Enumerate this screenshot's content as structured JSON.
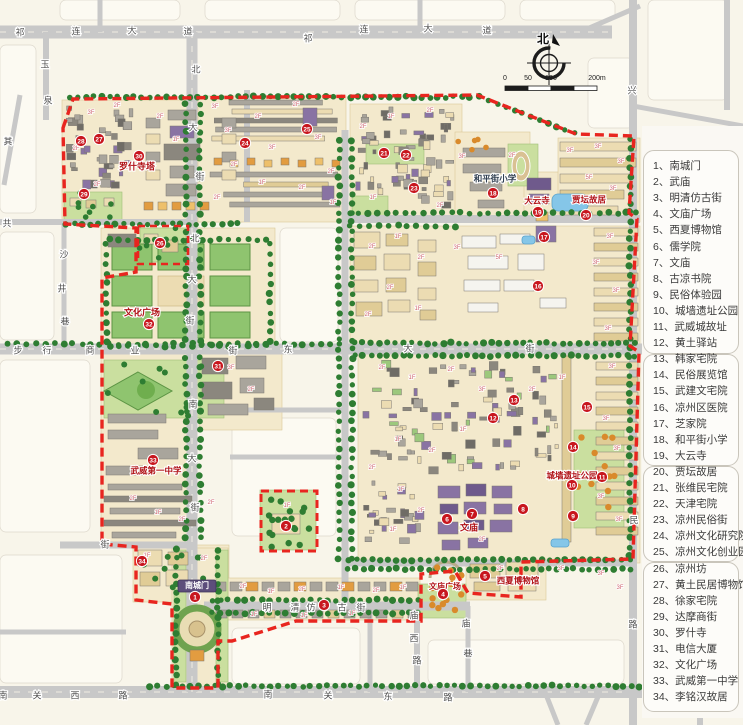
{
  "legend": {
    "items": [
      {
        "num": "1",
        "label": "南城门"
      },
      {
        "num": "2",
        "label": "武庙"
      },
      {
        "num": "3",
        "label": "明清仿古街"
      },
      {
        "num": "4",
        "label": "文庙广场"
      },
      {
        "num": "5",
        "label": "西夏博物馆"
      },
      {
        "num": "6",
        "label": "儒学院"
      },
      {
        "num": "7",
        "label": "文庙"
      },
      {
        "num": "8",
        "label": "古凉书院"
      },
      {
        "num": "9",
        "label": "民俗体验园"
      },
      {
        "num": "10",
        "label": "城墙遗址公园"
      },
      {
        "num": "11",
        "label": "武威城故址"
      },
      {
        "num": "12",
        "label": "黄土驿站"
      },
      {
        "num": "13",
        "label": "韩家宅院"
      },
      {
        "num": "14",
        "label": "民俗展览馆"
      },
      {
        "num": "15",
        "label": "武建文宅院"
      },
      {
        "num": "16",
        "label": "凉州区医院"
      },
      {
        "num": "17",
        "label": "芝家院"
      },
      {
        "num": "18",
        "label": "和平街小学"
      },
      {
        "num": "19",
        "label": "大云寺"
      },
      {
        "num": "20",
        "label": "贾坛故居"
      },
      {
        "num": "21",
        "label": "张维民宅院"
      },
      {
        "num": "22",
        "label": "天津宅院"
      },
      {
        "num": "23",
        "label": "凉州民俗街"
      },
      {
        "num": "24",
        "label": "凉州文化研究院"
      },
      {
        "num": "25",
        "label": "凉州文化创业园"
      },
      {
        "num": "26",
        "label": "凉州坊"
      },
      {
        "num": "27",
        "label": "黄土民居博物馆"
      },
      {
        "num": "28",
        "label": "徐家宅院"
      },
      {
        "num": "29",
        "label": "达摩商街"
      },
      {
        "num": "30",
        "label": "罗什寺"
      },
      {
        "num": "31",
        "label": "电信大厦"
      },
      {
        "num": "32",
        "label": "文化广场"
      },
      {
        "num": "33",
        "label": "武威第一中学"
      },
      {
        "num": "34",
        "label": "李铭汉故居"
      }
    ]
  },
  "compass": {
    "north": "北"
  },
  "scale_bar": {
    "ticks": [
      "0",
      "50",
      "100",
      "200m"
    ]
  },
  "markers": [
    [
      1,
      195,
      597
    ],
    [
      2,
      286,
      526
    ],
    [
      3,
      324,
      605
    ],
    [
      4,
      443,
      594
    ],
    [
      5,
      485,
      576
    ],
    [
      6,
      447,
      519
    ],
    [
      7,
      472,
      514
    ],
    [
      8,
      523,
      509
    ],
    [
      9,
      573,
      516
    ],
    [
      10,
      572,
      485
    ],
    [
      11,
      602,
      477
    ],
    [
      12,
      493,
      418
    ],
    [
      13,
      514,
      400
    ],
    [
      14,
      573,
      447
    ],
    [
      15,
      587,
      407
    ],
    [
      16,
      538,
      286
    ],
    [
      17,
      544,
      237
    ],
    [
      18,
      493,
      193
    ],
    [
      19,
      538,
      212
    ],
    [
      20,
      586,
      215
    ],
    [
      21,
      384,
      153
    ],
    [
      22,
      406,
      155
    ],
    [
      23,
      414,
      188
    ],
    [
      24,
      245,
      143
    ],
    [
      25,
      307,
      129
    ],
    [
      26,
      160,
      243
    ],
    [
      27,
      99,
      139
    ],
    [
      28,
      81,
      141
    ],
    [
      29,
      84,
      194
    ],
    [
      30,
      139,
      156
    ],
    [
      31,
      218,
      366
    ],
    [
      32,
      149,
      324
    ],
    [
      33,
      153,
      460
    ],
    [
      34,
      142,
      561
    ]
  ],
  "streets": [
    {
      "name": "qilian-avenue-west",
      "chars": [
        [
          "祁",
          20,
          33
        ],
        [
          "连",
          76,
          32
        ],
        [
          "大",
          132,
          31
        ],
        [
          "道",
          188,
          32
        ]
      ]
    },
    {
      "name": "qilian-avenue-east",
      "chars": [
        [
          "祁",
          308,
          39
        ],
        [
          "连",
          364,
          30
        ],
        [
          "大",
          428,
          29
        ],
        [
          "道",
          487,
          31
        ]
      ]
    },
    {
      "name": "bei-da-jie-upper",
      "chars": [
        [
          "北",
          196,
          70
        ],
        [
          "大",
          193,
          128
        ],
        [
          "街",
          200,
          177
        ]
      ]
    },
    {
      "name": "bei-da-jie-lower",
      "chars": [
        [
          "北",
          195,
          239
        ],
        [
          "大",
          192,
          280
        ],
        [
          "街",
          190,
          321
        ]
      ]
    },
    {
      "name": "nan-da-jie",
      "chars": [
        [
          "南",
          193,
          405
        ],
        [
          "大",
          192,
          459
        ],
        [
          "街",
          195,
          508
        ]
      ]
    },
    {
      "name": "dong-da-jie",
      "chars": [
        [
          "东",
          288,
          350
        ],
        [
          "大",
          408,
          349
        ],
        [
          "街",
          530,
          349
        ]
      ]
    },
    {
      "name": "buxing-shangye-jie",
      "chars": [
        [
          "步",
          18,
          351
        ],
        [
          "行",
          47,
          351
        ],
        [
          "商",
          90,
          351
        ],
        [
          "业",
          135,
          351
        ],
        [
          "街",
          233,
          351
        ]
      ]
    },
    {
      "name": "shajing-lane",
      "chars": [
        [
          "沙",
          64,
          255
        ],
        [
          "井",
          62,
          289
        ],
        [
          "巷",
          65,
          322
        ]
      ]
    },
    {
      "name": "yuquan-road",
      "chars": [
        [
          "玉",
          45,
          65
        ],
        [
          "泉",
          48,
          101
        ]
      ]
    },
    {
      "name": "west-edge-street",
      "chars": [
        [
          "其",
          8,
          142
        ]
      ]
    },
    {
      "name": "gong-street",
      "chars": [
        [
          "共",
          7,
          224
        ]
      ]
    },
    {
      "name": "west-jie",
      "chars": [
        [
          "街",
          105,
          545
        ]
      ]
    },
    {
      "name": "mingqing-fanggu-jie",
      "chars": [
        [
          "明",
          267,
          608
        ],
        [
          "清",
          295,
          608
        ],
        [
          "仿",
          311,
          608
        ],
        [
          "古",
          342,
          608
        ],
        [
          "街",
          361,
          608
        ]
      ]
    },
    {
      "name": "miaoxi-road",
      "chars": [
        [
          "庙",
          414,
          616
        ],
        [
          "西",
          414,
          639
        ],
        [
          "路",
          417,
          661
        ]
      ]
    },
    {
      "name": "miao-lane",
      "chars": [
        [
          "庙",
          466,
          624
        ],
        [
          "巷",
          468,
          654
        ]
      ]
    },
    {
      "name": "nanguan-west-road",
      "chars": [
        [
          "南",
          3,
          696
        ],
        [
          "关",
          37,
          696
        ],
        [
          "西",
          75,
          696
        ],
        [
          "路",
          123,
          696
        ]
      ]
    },
    {
      "name": "nanguan-east-road",
      "chars": [
        [
          "南",
          268,
          695
        ],
        [
          "关",
          328,
          696
        ],
        [
          "东",
          388,
          697
        ],
        [
          "路",
          448,
          698
        ]
      ]
    },
    {
      "name": "east-edge-roads",
      "chars": [
        [
          "兴",
          632,
          91
        ],
        [
          "民",
          634,
          521
        ],
        [
          "路",
          633,
          625
        ]
      ]
    }
  ],
  "map_labels": [
    {
      "text": "罗什寺塔",
      "x": 137,
      "y": 167,
      "color": "#b01116",
      "size": 9
    },
    {
      "text": "文化广场",
      "x": 142,
      "y": 313,
      "color": "#b01116",
      "size": 9
    },
    {
      "text": "武威第一中学",
      "x": 156,
      "y": 471,
      "color": "#b01116",
      "size": 8.5
    },
    {
      "text": "文庙广场",
      "x": 445,
      "y": 587,
      "color": "#b01116",
      "size": 8
    },
    {
      "text": "西夏博物馆",
      "x": 518,
      "y": 581,
      "color": "#b01116",
      "size": 8.5
    },
    {
      "text": "文庙",
      "x": 469,
      "y": 528,
      "color": "#b01116",
      "size": 9
    },
    {
      "text": "城墙遗址公园",
      "x": 572,
      "y": 476,
      "color": "#b01116",
      "size": 8.5
    },
    {
      "text": "大云寺",
      "x": 537,
      "y": 201,
      "color": "#b01116",
      "size": 8.5
    },
    {
      "text": "贾坛故居",
      "x": 589,
      "y": 200,
      "color": "#b01116",
      "size": 8.5
    },
    {
      "text": "和平街小学",
      "x": 495,
      "y": 179,
      "color": "#2f3e50",
      "size": 8.5
    },
    {
      "text": "南城门",
      "x": 197,
      "y": 586,
      "color": "#ffffff",
      "size": 8,
      "chip": "#5d4e7b"
    }
  ],
  "floor_labels": [
    [
      "3F",
      91,
      114
    ],
    [
      "2F",
      117,
      107
    ],
    [
      "2F",
      76,
      150
    ],
    [
      "1F",
      128,
      169
    ],
    [
      "2F",
      97,
      186
    ],
    [
      "2F",
      160,
      118
    ],
    [
      "1F",
      176,
      141
    ],
    [
      "3F",
      215,
      108
    ],
    [
      "3F",
      228,
      132
    ],
    [
      "2F",
      258,
      118
    ],
    [
      "3F",
      272,
      149
    ],
    [
      "2F",
      296,
      106
    ],
    [
      "3F",
      318,
      139
    ],
    [
      "2F",
      234,
      166
    ],
    [
      "1F",
      262,
      184
    ],
    [
      "2F",
      302,
      189
    ],
    [
      "2F",
      331,
      173
    ],
    [
      "2F",
      217,
      199
    ],
    [
      "1F",
      333,
      204
    ],
    [
      "2F",
      363,
      128
    ],
    [
      "1F",
      391,
      118
    ],
    [
      "2F",
      430,
      112
    ],
    [
      "1F",
      373,
      199
    ],
    [
      "2F",
      440,
      207
    ],
    [
      "3F",
      462,
      158
    ],
    [
      "2F",
      512,
      157
    ],
    [
      "3F",
      570,
      152
    ],
    [
      "3F",
      598,
      148
    ],
    [
      "3F",
      621,
      163
    ],
    [
      "5F",
      589,
      179
    ],
    [
      "3F",
      613,
      190
    ],
    [
      "2F",
      372,
      248
    ],
    [
      "1F",
      398,
      238
    ],
    [
      "2F",
      421,
      259
    ],
    [
      "3F",
      457,
      249
    ],
    [
      "5F",
      499,
      259
    ],
    [
      "3F",
      610,
      238
    ],
    [
      "3F",
      596,
      264
    ],
    [
      "3F",
      616,
      292
    ],
    [
      "2F",
      390,
      289
    ],
    [
      "1F",
      418,
      310
    ],
    [
      "2F",
      368,
      316
    ],
    [
      "3F",
      608,
      330
    ],
    [
      "2F",
      382,
      369
    ],
    [
      "1F",
      412,
      379
    ],
    [
      "2F",
      451,
      371
    ],
    [
      "3F",
      482,
      391
    ],
    [
      "2F",
      532,
      391
    ],
    [
      "1F",
      562,
      379
    ],
    [
      "3F",
      612,
      368
    ],
    [
      "3F",
      606,
      420
    ],
    [
      "3F",
      617,
      450
    ],
    [
      "3F",
      601,
      498
    ],
    [
      "3F",
      619,
      521
    ],
    [
      "1F",
      398,
      441
    ],
    [
      "2F",
      432,
      452
    ],
    [
      "1F",
      463,
      431
    ],
    [
      "2F",
      372,
      469
    ],
    [
      "1F",
      401,
      491
    ],
    [
      "2F",
      421,
      512
    ],
    [
      "1F",
      393,
      531
    ],
    [
      "2F",
      482,
      541
    ],
    [
      "3F",
      231,
      369
    ],
    [
      "2F",
      251,
      391
    ],
    [
      "2F",
      133,
      500
    ],
    [
      "1F",
      158,
      514
    ],
    [
      "2F",
      182,
      521
    ],
    [
      "2F",
      211,
      504
    ],
    [
      "2F",
      243,
      588
    ],
    [
      "1F",
      271,
      593
    ],
    [
      "2F",
      302,
      591
    ],
    [
      "1F",
      341,
      589
    ],
    [
      "2F",
      376,
      592
    ],
    [
      "1F",
      403,
      589
    ],
    [
      "1F",
      254,
      616
    ],
    [
      "1F",
      304,
      617
    ],
    [
      "1F",
      352,
      615
    ],
    [
      "2F",
      500,
      570
    ],
    [
      "2F",
      529,
      584
    ],
    [
      "3F",
      561,
      570
    ],
    [
      "3F",
      601,
      575
    ],
    [
      "3F",
      620,
      589
    ],
    [
      "1F",
      287,
      507
    ],
    [
      "1F",
      147,
      557
    ],
    [
      "2F",
      204,
      560
    ]
  ],
  "colors": {
    "boundary": "#e8251f",
    "marker": "#c8161e",
    "road": "#c8c8c8",
    "water": "#85c6e8",
    "tree": "#2e7d32",
    "orange_tree": "#d98a2b",
    "red_text": "#b01116"
  }
}
